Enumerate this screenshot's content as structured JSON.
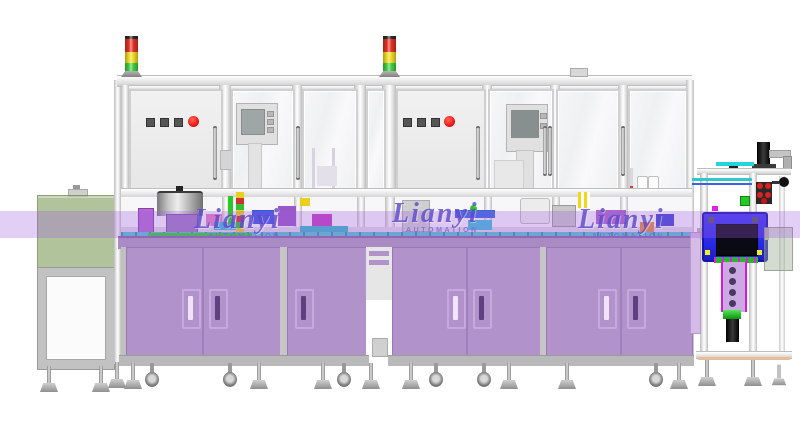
{
  "watermarks": [
    {
      "brand": "Lianyi",
      "subtitle": "AUTOMATION"
    },
    {
      "brand": "Lianyi",
      "subtitle": "AUTOMATION"
    },
    {
      "brand": "Lianyi",
      "subtitle": "AUTOMATION"
    }
  ],
  "palette": {
    "band": "rgba(162,92,226,0.30)",
    "cabinet": "#b292cb",
    "cabinet_edge": "#9a77b5",
    "table": "#a98ac3",
    "frame": "#e6e6e6",
    "frame_edge": "#bdbdbd",
    "door": "#ececec",
    "tower_red": "#e33022",
    "tower_yellow": "#eed823",
    "tower_green": "#3fcb3d",
    "button_red": "#ee1616",
    "button_dark": "#565656",
    "conveyor_teal": "#56c6cc",
    "accent_green": "#2ed32e",
    "cover_green": "rgba(128,158,94,0.62)",
    "box_blue": "#2b2be8",
    "column_lavender": "#cba9e2",
    "watermark": "#5e4cc9",
    "base_gray": "#b9b9b9"
  }
}
